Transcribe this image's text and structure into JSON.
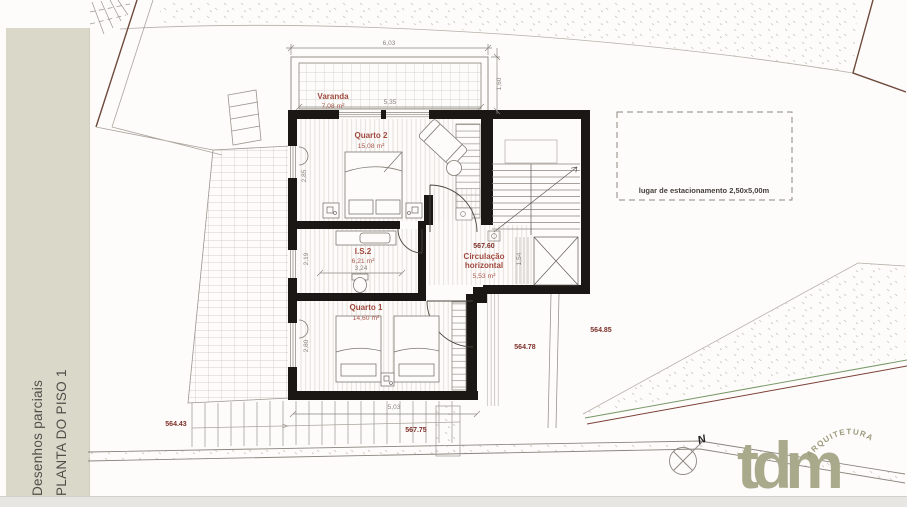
{
  "document": {
    "panel_title_line1": "Desenhos parciais",
    "panel_title_line2": "PLANTA DO PISO 1"
  },
  "plan": {
    "varanda": {
      "name": "Varanda",
      "area": "7,08 m²"
    },
    "quarto2": {
      "name": "Quarto 2",
      "area": "15,08 m²"
    },
    "is2": {
      "name": "I.S.2",
      "area": "6,21 m²"
    },
    "quarto1": {
      "name": "Quarto 1",
      "area": "14,60 m²"
    },
    "circulacao": {
      "level": "567.60",
      "name_line1": "Circulação",
      "name_line2": "horizontal",
      "area": "5,53 m²"
    },
    "dims": {
      "total_width": "6,03",
      "varanda_width": "5,35",
      "varanda_depth": "1,60",
      "quarto2_depth": "2,85",
      "is2_depth": "2,19",
      "is2_width": "3,24",
      "quarto1_depth": "2,80",
      "quarto1_width": "5,03",
      "stair_width": "1,54"
    },
    "levels": {
      "west": "564.43",
      "south": "567.75",
      "east_near": "564.78",
      "east_far": "564.85"
    },
    "parking": {
      "label": "lugar de estacionamento 2,50x5,00m"
    }
  },
  "compass": {
    "label": "N"
  },
  "logo": {
    "wordmark": "tdm",
    "subtitle": "ARQUITETURA"
  },
  "colors": {
    "wall": "#1a1714",
    "room_label": "#a0483e",
    "level_marker": "#7e2f29",
    "dimension_text": "#8b8680",
    "sidebar_panel": "#d9d8c9",
    "logo": "#a9a98b"
  }
}
